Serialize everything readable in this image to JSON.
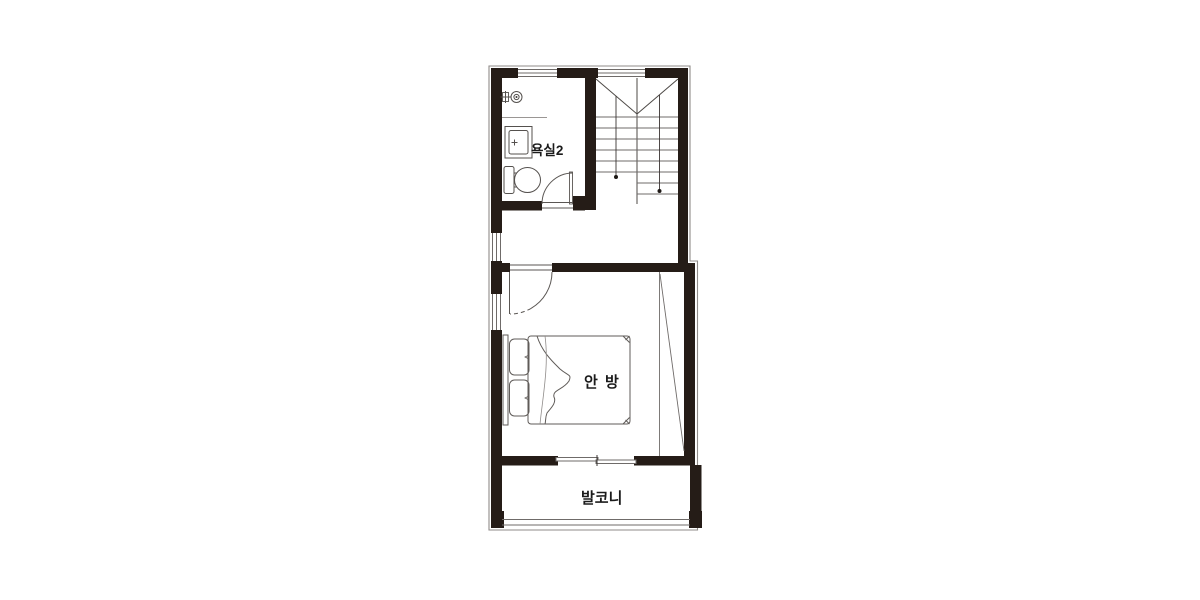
{
  "plan": {
    "type": "apartment-floor-plan",
    "rooms": {
      "bathroom": {
        "label": "욕실2"
      },
      "bedroom": {
        "label": "안 방"
      },
      "balcony": {
        "label": "발코니"
      }
    },
    "fixtures": [
      "shower-valve",
      "sink",
      "toilet",
      "staircase",
      "double-bed",
      "pillows",
      "swing-doors",
      "sliding-window"
    ],
    "colors": {
      "wall": "#251c17",
      "outline": "#8f8b89",
      "thin_line": "#6f6b69",
      "light_line": "#9a9694",
      "label_text": "#1b1b1b",
      "background": "#ffffff"
    }
  }
}
